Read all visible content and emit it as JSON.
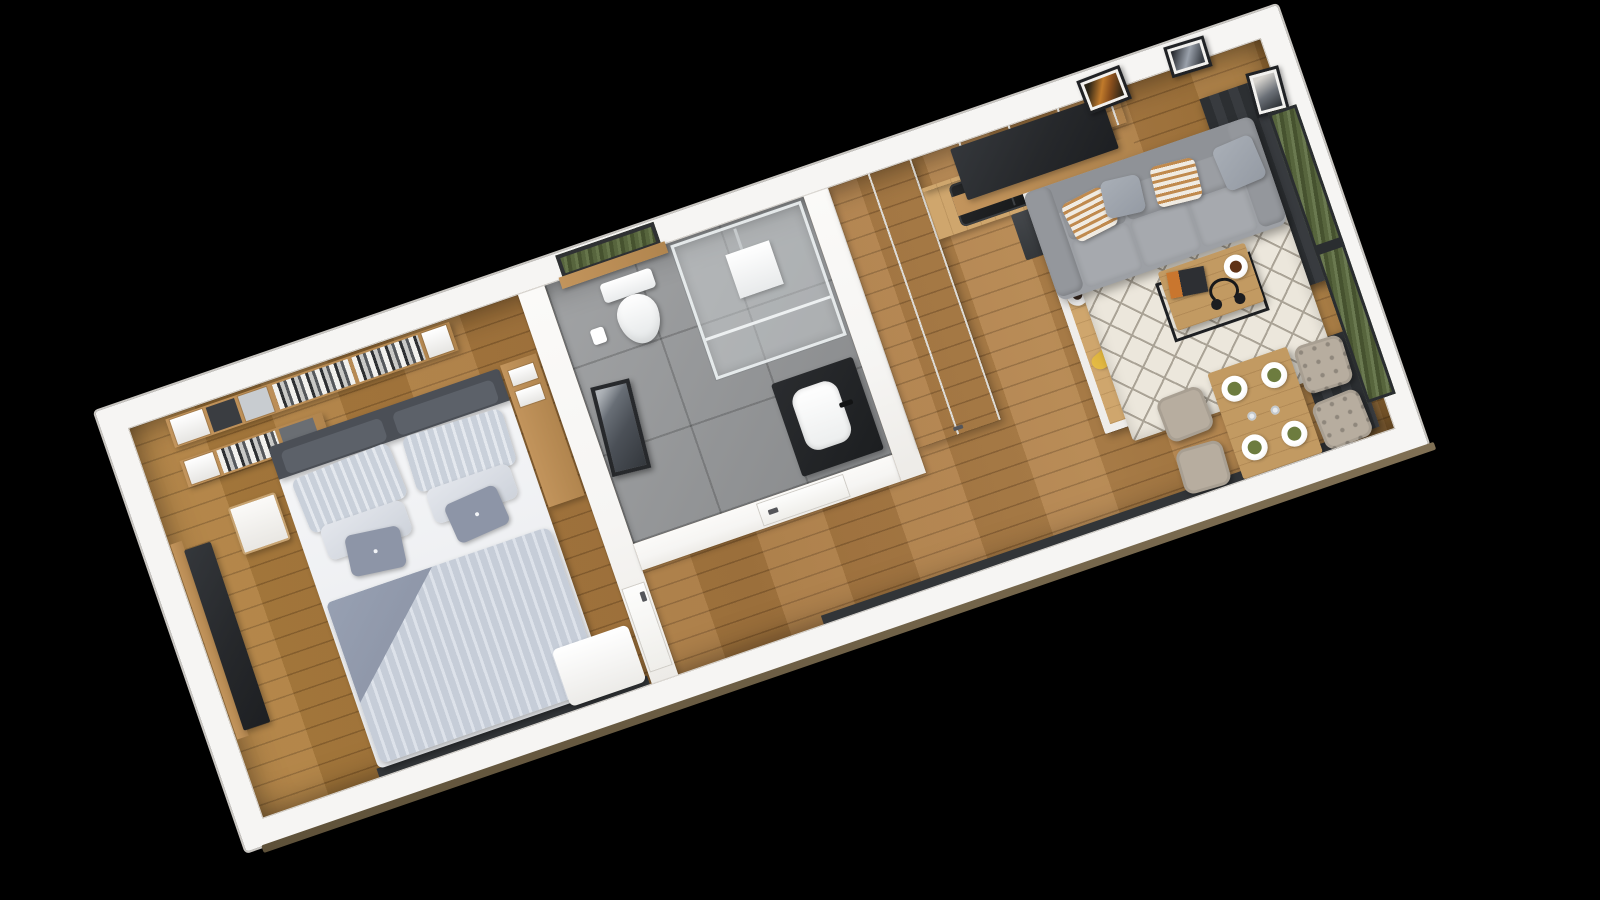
{
  "scene": {
    "title": "3D rendered top-down floor plan of a studio apartment",
    "style": "photorealistic architectural 3D render on black background",
    "rotation_deg": -19,
    "background": "#000000"
  },
  "palette": {
    "background": "#000000",
    "wall": "#f6f5f3",
    "wood_floor": "#ab7a41",
    "wood_shelf": "#c2945c",
    "counter_wood": "#cfa66d",
    "tile": "#97999b",
    "charcoal": "#323538",
    "tv_black": "#26282b",
    "sofa": "#9da0a5",
    "sofa_dark": "#8f9297",
    "bed_stripe": "#c9d0da",
    "bed_stripe2": "#e4e8ee",
    "blanket": "#8d95a7",
    "headboard": "#4b4f56",
    "rug": "#ece7dc",
    "rug_line": "#aaa396",
    "chair": "#b7ad9f",
    "grass": "#57653d",
    "pillow_stripe": "#c08a4e",
    "napkin": "#6d7c3f"
  },
  "rooms": [
    {
      "name": "Bedroom",
      "floor": "wood planks",
      "furniture": [
        "Double bed with striped duvet and pillows",
        "Wall shelf with books and boxes",
        "Lower wall shelf with boxes",
        "Nightstand",
        "TV panel on wood board",
        "Wardrobe column",
        "White storage chest"
      ]
    },
    {
      "name": "Bathroom",
      "floor": "gray tile",
      "furniture": [
        "Toilet",
        "Toilet paper holder",
        "Leaning picture frame",
        "Walk-in glass shower",
        "Black vanity with white basin",
        "Window with greenery",
        "Bathroom door"
      ]
    },
    {
      "name": "Hallway",
      "floor": "wood planks",
      "furniture": [
        "Bedroom door",
        "Built-in white closet"
      ]
    },
    {
      "name": "Kitchen",
      "floor": "wood planks",
      "furniture": [
        "White upper cabinets",
        "Counter with black sink and faucet",
        "Dark cooktop",
        "Wood peninsula counter",
        "Red kettle",
        "Fruit bowl with apples",
        "Loose apple",
        "Plate with pancakes",
        "Espresso plate",
        "Vegetable crate",
        "Bananas",
        "Cutting board"
      ]
    },
    {
      "name": "Living room",
      "floor": "wood planks",
      "furniture": [
        "Wall TV on wood board",
        "Gray three-seat sofa",
        "Striped accent pillow",
        "Gray accent pillow",
        "Cream trellis rug",
        "Coffee table with black wire base",
        "Headphones",
        "Coffee cup on saucer",
        "Magazine",
        "Dining table with four place settings",
        "Place setting with green napkin",
        "Upholstered chair",
        "Tufted chair",
        "Picture frame with orange artwork",
        "Picture frame with gray artwork",
        "Picture frame on right wall",
        "Dark curtain panel",
        "Glass door with grass view",
        "Low window strip"
      ]
    }
  ]
}
